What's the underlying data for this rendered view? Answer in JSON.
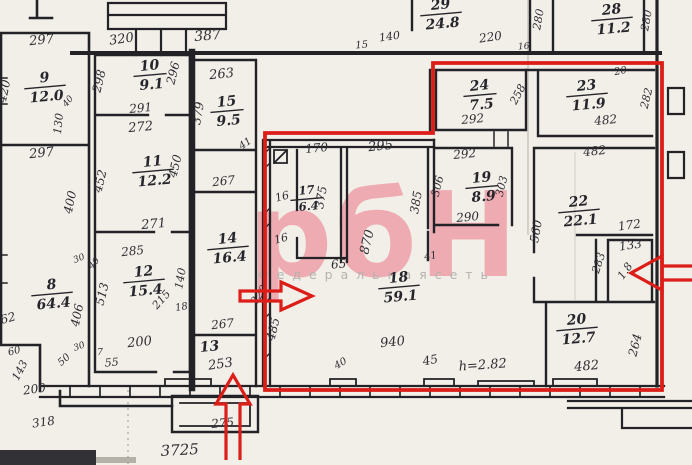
{
  "watermark": {
    "logo": "рбН",
    "tagline": "Ф е д е р а л ь н а я   с е т ь",
    "logo_color": "#eeacb2",
    "tagline_color": "#b5b2ae"
  },
  "overlay": {
    "color": "#dc1d18",
    "meaning": "selected-unit-boundary",
    "arrows": [
      "right",
      "up",
      "left"
    ]
  },
  "plan": {
    "overall_width_label": "3725",
    "ceiling_height_label": "h=2.82",
    "rooms": [
      {
        "number": "9",
        "area": "12.0",
        "x": 45,
        "y": 86
      },
      {
        "number": "10",
        "area": "9.1",
        "x": 150,
        "y": 74
      },
      {
        "number": "11",
        "area": "12.2",
        "x": 153,
        "y": 170
      },
      {
        "number": "12",
        "area": "15.4",
        "x": 144,
        "y": 280
      },
      {
        "number": "8",
        "area": "64.4",
        "x": 52,
        "y": 293
      },
      {
        "number": "15",
        "area": "9.5",
        "x": 227,
        "y": 110
      },
      {
        "number": "14",
        "area": "16.4",
        "x": 228,
        "y": 247
      },
      {
        "number": "13",
        "area": null,
        "x": 210,
        "y": 347
      },
      {
        "number": "17",
        "area": "6.4",
        "x": 307,
        "y": 198,
        "small": true
      },
      {
        "number": "18",
        "area": "59.1",
        "x": 399,
        "y": 286
      },
      {
        "number": "19",
        "area": "8.9",
        "x": 482,
        "y": 186
      },
      {
        "number": "24",
        "area": "7.5",
        "x": 480,
        "y": 94
      },
      {
        "number": "23",
        "area": "11.9",
        "x": 587,
        "y": 94
      },
      {
        "number": "28",
        "area": "11.2",
        "x": 612,
        "y": 18
      },
      {
        "number": "29",
        "area": "24.8",
        "x": 441,
        "y": 13
      },
      {
        "number": "22",
        "area": "22.1",
        "x": 579,
        "y": 210
      },
      {
        "number": "20",
        "area": "12.7",
        "x": 577,
        "y": 328
      }
    ],
    "dims": [
      {
        "t": "297",
        "x": 42,
        "y": 44,
        "r": -6,
        "s": 13
      },
      {
        "t": "420",
        "x": 8,
        "y": 92,
        "r": -78,
        "s": 12
      },
      {
        "t": "40",
        "x": 70,
        "y": 103,
        "r": -50,
        "s": 9
      },
      {
        "t": "130",
        "x": 62,
        "y": 124,
        "r": -84,
        "s": 11
      },
      {
        "t": "297",
        "x": 42,
        "y": 157,
        "r": -6,
        "s": 13
      },
      {
        "t": "400",
        "x": 74,
        "y": 203,
        "r": -78,
        "s": 12
      },
      {
        "t": "406",
        "x": 81,
        "y": 316,
        "r": -78,
        "s": 12
      },
      {
        "t": "62",
        "x": 9,
        "y": 322,
        "r": -15,
        "s": 12
      },
      {
        "t": "60",
        "x": 15,
        "y": 354,
        "r": -15,
        "s": 10
      },
      {
        "t": "143",
        "x": 23,
        "y": 372,
        "r": -62,
        "s": 11
      },
      {
        "t": "200",
        "x": 35,
        "y": 393,
        "r": -8,
        "s": 12
      },
      {
        "t": "318",
        "x": 44,
        "y": 426,
        "r": -8,
        "s": 12
      },
      {
        "t": "30",
        "x": 80,
        "y": 349,
        "r": -20,
        "s": 9
      },
      {
        "t": "7",
        "x": 100,
        "y": 355,
        "r": 0,
        "s": 9
      },
      {
        "t": "50",
        "x": 66,
        "y": 362,
        "r": -42,
        "s": 10
      },
      {
        "t": "55",
        "x": 112,
        "y": 366,
        "r": -5,
        "s": 11
      },
      {
        "t": "30",
        "x": 80,
        "y": 261,
        "r": -22,
        "s": 9
      },
      {
        "t": "40",
        "x": 96,
        "y": 265,
        "r": -48,
        "s": 9
      },
      {
        "t": "320",
        "x": 122,
        "y": 43,
        "r": -8,
        "s": 13
      },
      {
        "t": "298",
        "x": 103,
        "y": 82,
        "r": -76,
        "s": 12
      },
      {
        "t": "296",
        "x": 177,
        "y": 74,
        "r": -76,
        "s": 12
      },
      {
        "t": "291",
        "x": 141,
        "y": 112,
        "r": -5,
        "s": 12
      },
      {
        "t": "272",
        "x": 141,
        "y": 131,
        "r": -5,
        "s": 13
      },
      {
        "t": "452",
        "x": 104,
        "y": 182,
        "r": -76,
        "s": 12
      },
      {
        "t": "450",
        "x": 179,
        "y": 167,
        "r": -76,
        "s": 12
      },
      {
        "t": "271",
        "x": 154,
        "y": 228,
        "r": -5,
        "s": 13
      },
      {
        "t": "285",
        "x": 133,
        "y": 255,
        "r": -6,
        "s": 12
      },
      {
        "t": "513",
        "x": 106,
        "y": 295,
        "r": -76,
        "s": 12
      },
      {
        "t": "140",
        "x": 184,
        "y": 279,
        "r": -80,
        "s": 11
      },
      {
        "t": "215",
        "x": 164,
        "y": 302,
        "r": -48,
        "s": 11
      },
      {
        "t": "18",
        "x": 182,
        "y": 310,
        "r": -10,
        "s": 10
      },
      {
        "t": "200",
        "x": 140,
        "y": 346,
        "r": -6,
        "s": 13
      },
      {
        "t": "387",
        "x": 208,
        "y": 40,
        "r": -5,
        "s": 14
      },
      {
        "t": "263",
        "x": 222,
        "y": 78,
        "r": -6,
        "s": 13
      },
      {
        "t": "379",
        "x": 202,
        "y": 114,
        "r": -80,
        "s": 12
      },
      {
        "t": "41",
        "x": 247,
        "y": 146,
        "r": -35,
        "s": 10
      },
      {
        "t": "267",
        "x": 224,
        "y": 185,
        "r": -6,
        "s": 12
      },
      {
        "t": "267",
        "x": 223,
        "y": 328,
        "r": -6,
        "s": 12
      },
      {
        "t": "253",
        "x": 221,
        "y": 368,
        "r": -8,
        "s": 13
      },
      {
        "t": "275",
        "x": 223,
        "y": 427,
        "r": -5,
        "s": 12
      },
      {
        "t": "170",
        "x": 317,
        "y": 152,
        "r": -5,
        "s": 12
      },
      {
        "t": "16",
        "x": 283,
        "y": 200,
        "r": -15,
        "s": 11
      },
      {
        "t": "375",
        "x": 325,
        "y": 198,
        "r": -80,
        "s": 12
      },
      {
        "t": "16",
        "x": 282,
        "y": 242,
        "r": -15,
        "s": 11
      },
      {
        "t": "295",
        "x": 381,
        "y": 150,
        "r": -6,
        "s": 13
      },
      {
        "t": "870",
        "x": 371,
        "y": 243,
        "r": -76,
        "s": 13
      },
      {
        "t": "385",
        "x": 420,
        "y": 203,
        "r": -80,
        "s": 12
      },
      {
        "t": "65",
        "x": 339,
        "y": 268,
        "r": -5,
        "s": 12
      },
      {
        "t": "41",
        "x": 431,
        "y": 259,
        "r": -10,
        "s": 10
      },
      {
        "t": "485",
        "x": 277,
        "y": 330,
        "r": -76,
        "s": 12
      },
      {
        "t": "220",
        "x": 262,
        "y": 297,
        "r": -55,
        "s": 11
      },
      {
        "t": "940",
        "x": 393,
        "y": 346,
        "r": -6,
        "s": 13
      },
      {
        "t": "40",
        "x": 342,
        "y": 366,
        "r": -30,
        "s": 10
      },
      {
        "t": "45",
        "x": 431,
        "y": 364,
        "r": -10,
        "s": 12
      },
      {
        "t": "h=2.82",
        "x": 483,
        "y": 369,
        "r": -4,
        "s": 13
      },
      {
        "t": "140",
        "x": 390,
        "y": 40,
        "r": -8,
        "s": 11
      },
      {
        "t": "15",
        "x": 362,
        "y": 48,
        "r": -5,
        "s": 10
      },
      {
        "t": "220",
        "x": 491,
        "y": 41,
        "r": -8,
        "s": 12
      },
      {
        "t": "16",
        "x": 524,
        "y": 49,
        "r": -5,
        "s": 9
      },
      {
        "t": "280",
        "x": 542,
        "y": 20,
        "r": -80,
        "s": 11
      },
      {
        "t": "280",
        "x": 650,
        "y": 21,
        "r": -80,
        "s": 11
      },
      {
        "t": "292",
        "x": 473,
        "y": 123,
        "r": -5,
        "s": 12
      },
      {
        "t": "258",
        "x": 521,
        "y": 96,
        "r": -62,
        "s": 11
      },
      {
        "t": "482",
        "x": 606,
        "y": 124,
        "r": -5,
        "s": 12
      },
      {
        "t": "282",
        "x": 650,
        "y": 99,
        "r": -76,
        "s": 11
      },
      {
        "t": "20",
        "x": 621,
        "y": 74,
        "r": -10,
        "s": 10
      },
      {
        "t": "292",
        "x": 465,
        "y": 158,
        "r": -5,
        "s": 12
      },
      {
        "t": "306",
        "x": 441,
        "y": 187,
        "r": -76,
        "s": 11
      },
      {
        "t": "303",
        "x": 505,
        "y": 187,
        "r": -76,
        "s": 11
      },
      {
        "t": "290",
        "x": 468,
        "y": 221,
        "r": -5,
        "s": 12
      },
      {
        "t": "482",
        "x": 595,
        "y": 155,
        "r": -6,
        "s": 12
      },
      {
        "t": "560",
        "x": 540,
        "y": 232,
        "r": -80,
        "s": 12
      },
      {
        "t": "172",
        "x": 630,
        "y": 229,
        "r": -8,
        "s": 12
      },
      {
        "t": "133",
        "x": 631,
        "y": 249,
        "r": -8,
        "s": 12
      },
      {
        "t": "283",
        "x": 602,
        "y": 264,
        "r": -72,
        "s": 11
      },
      {
        "t": "1.8",
        "x": 628,
        "y": 273,
        "r": -55,
        "s": 11
      },
      {
        "t": "482",
        "x": 587,
        "y": 370,
        "r": -5,
        "s": 13
      },
      {
        "t": "264",
        "x": 639,
        "y": 346,
        "r": -76,
        "s": 12
      },
      {
        "t": "3725",
        "x": 180,
        "y": 455,
        "r": -3,
        "s": 15
      }
    ]
  }
}
